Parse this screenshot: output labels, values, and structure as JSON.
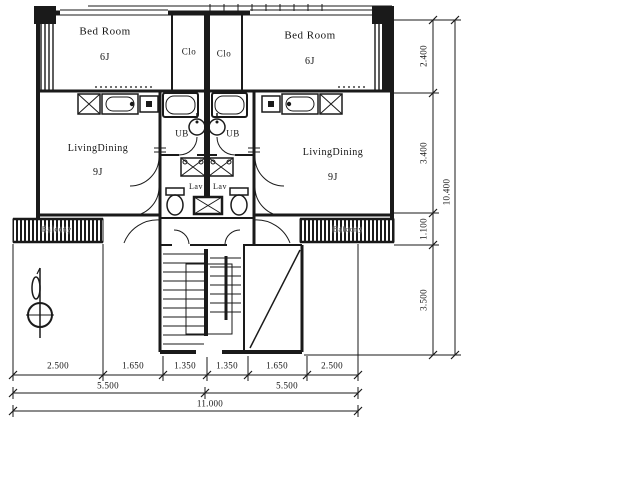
{
  "drawing": {
    "type": "architectural floor plan, two mirrored apartment units with central stair core",
    "units": {
      "left": {
        "bedroom": {
          "label": "Bed Room",
          "size": "6J"
        },
        "closet": "Clo",
        "living": {
          "label": "LivingDining",
          "size": "9J"
        },
        "bath": "UB",
        "lavatory": "Lav",
        "balcony": "Balcony"
      },
      "right": {
        "bedroom": {
          "label": "Bed Room",
          "size": "6J"
        },
        "closet": "Clo",
        "living": {
          "label": "LivingDining",
          "size": "9J"
        },
        "bath": "UB",
        "lavatory": "Lav",
        "balcony": "Balcony"
      }
    },
    "dimensions": {
      "bottom": {
        "segments": [
          "2.500",
          "1.650",
          "1.350",
          "1.350",
          "1.650",
          "2.500"
        ],
        "subtotals": [
          "5.500",
          "5.500"
        ],
        "total": "11.000"
      },
      "right": {
        "segments": [
          "2.400",
          "3.400",
          "1.100",
          "3.500"
        ],
        "total": "10.400"
      }
    },
    "colors": {
      "ink": "#1a1a1a",
      "paper": "#ffffff"
    }
  }
}
